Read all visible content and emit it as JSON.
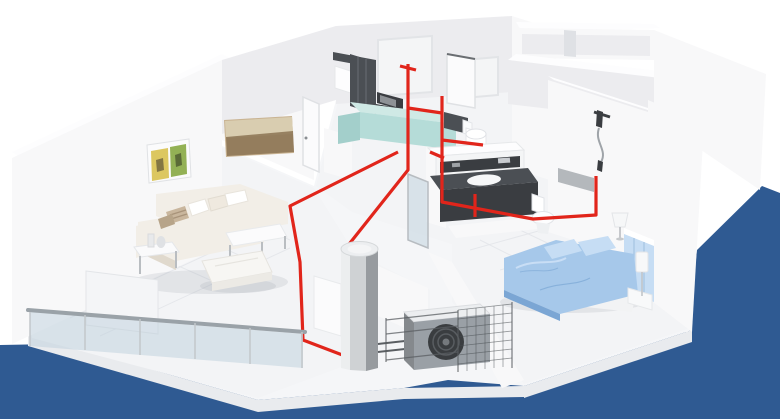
{
  "scene": {
    "title": "apartment-heat-pump-cutaway-3d-render",
    "description": "Isometric 3D cutaway of an apartment showing a heat pump heating system: red piping runs from a central hot water cylinder to the kitchen, bathrooms and shower; an outdoor unit sits on a fenced balcony; blue backdrop at right and bottom.",
    "colors": {
      "backdrop_blue": "#2f5a92",
      "pipe_red": "#e1251b",
      "wall_white": "#f8f8f9",
      "wall_shade": "#ececef",
      "wall_dark": "#dfe1e5",
      "floor_light": "#f3f4f6",
      "floor_line": "#e4e6ea",
      "slab_white": "#f5f6f8",
      "slab_edge": "#e9ebee",
      "teal_top": "#cfe9e5",
      "teal_face": "#b5dcd8",
      "teal_dark": "#a3cfcb",
      "dark_fixture": "#4b4f54",
      "fixture_darker": "#3a3d41",
      "sofa_cream": "#f2eee7",
      "sofa_shadow": "#e0d9cd",
      "pillow_tan": "#c9b69d",
      "bed_blue": "#a6c8ea",
      "bed_blue_light": "#c6ddf4",
      "bed_blue_dark": "#7ba6d4",
      "metal_light": "#eceeef",
      "metal_mid": "#cfd2d4",
      "metal_dark": "#979b9f",
      "unit_gray": "#9aa0a6",
      "fan_dark": "#3a3d40",
      "glass_tint": "rgba(185,205,218,0.45)",
      "rail_gray": "#9aa2a8",
      "art_tan": "#c9b392",
      "art_sky": "#d9cdb0",
      "art_dark": "#8b7354",
      "art_yellow": "#dcc760",
      "art_green": "#93b155"
    },
    "objects": [
      "left-exterior-wall",
      "living-room",
      "sectional-sofa",
      "coffee-table",
      "ottoman",
      "side-table",
      "radiator-panel",
      "wall-art-landscape",
      "wall-art-diptych",
      "kitchen",
      "kitchen-upper-cabinets",
      "microwave",
      "kitchen-teal-cabinets",
      "living-room-door",
      "kitchen-door",
      "bathroom",
      "washing-machine",
      "bathtub",
      "toilet",
      "guest-toilet",
      "vanity-sink",
      "shower-set",
      "bedroom",
      "double-bed",
      "headboard",
      "nightstand",
      "table-lamp",
      "floor-lamp",
      "storage-rooms",
      "hot-water-cylinder",
      "heat-pump-outdoor-unit",
      "protective-mesh-fence",
      "balcony-glass-railing",
      "red-heating-pipes",
      "blue-backdrop"
    ]
  }
}
